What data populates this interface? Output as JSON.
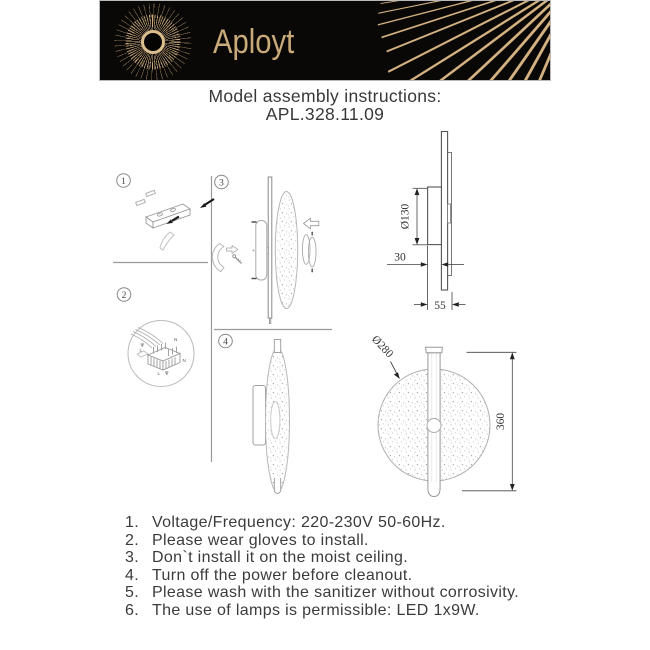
{
  "header": {
    "brand": "Aployt"
  },
  "title": {
    "heading": "Model assembly instructions:",
    "model": "APL.328.11.09"
  },
  "steps": [
    {
      "number": "1"
    },
    {
      "number": "2"
    },
    {
      "number": "3"
    },
    {
      "number": "4"
    }
  ],
  "wiring": {
    "top": "N",
    "left": "L",
    "right": "N",
    "bottom": "L"
  },
  "dimensions": {
    "bracket_diameter": "Ø130",
    "depth": "30",
    "total_depth": "55",
    "shade_diameter": "Ø280",
    "total_height": "360"
  },
  "instructions": {
    "items": [
      {
        "num": "1.",
        "text": "Voltage/Frequency: 220-230V 50-60Hz."
      },
      {
        "num": "2.",
        "text": "Please wear gloves to install."
      },
      {
        "num": "3.",
        "text": "Don`t install it on the moist ceiling."
      },
      {
        "num": "4.",
        "text": "Turn off the power before cleanout."
      },
      {
        "num": "5.",
        "text": "Please wash with the sanitizer without corrosivity."
      },
      {
        "num": "6.",
        "text": "The use of lamps is permissible: LED 1x9W."
      }
    ]
  },
  "colors": {
    "banner_bg": "#0a0806",
    "gold": "#d3b181",
    "text": "#3b3b3b",
    "line": "#9a9a9a"
  }
}
